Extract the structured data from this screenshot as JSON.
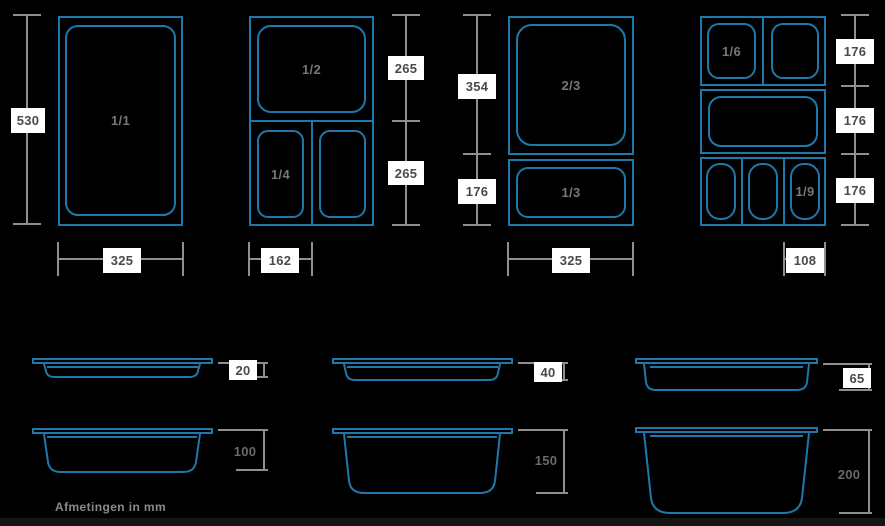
{
  "colors": {
    "background": "#000000",
    "pan_line": "#1e78aa",
    "dimension_line": "#8f8f8f",
    "label_box_bg": "#ffffff",
    "label_box_text": "#4a4a4a",
    "pan_label_text": "#777777"
  },
  "top_views": {
    "gn_1_1": {
      "pan_label": "1/1",
      "dim_height": "530",
      "dim_width": "325"
    },
    "gn_1_2": {
      "pan_label_top": "1/2",
      "pan_label_bottom_left": "1/4",
      "dim_right_top": "265",
      "dim_right_bottom": "265",
      "dim_width": "162"
    },
    "gn_2_3": {
      "pan_label_top": "2/3",
      "pan_label_bottom": "1/3",
      "dim_left_top": "354",
      "dim_left_bottom": "176",
      "dim_width": "325"
    },
    "gn_1_6": {
      "pan_label_top_left": "1/6",
      "pan_label_bottom_right": "1/9",
      "dim_right_top": "176",
      "dim_right_middle": "176",
      "dim_right_bottom": "176",
      "dim_width": "108"
    }
  },
  "side_views": {
    "depth_20": "20",
    "depth_40": "40",
    "depth_65": "65",
    "depth_100": "100",
    "depth_150": "150",
    "depth_200": "200"
  },
  "footer": {
    "note": "Afmetingen in mm"
  }
}
